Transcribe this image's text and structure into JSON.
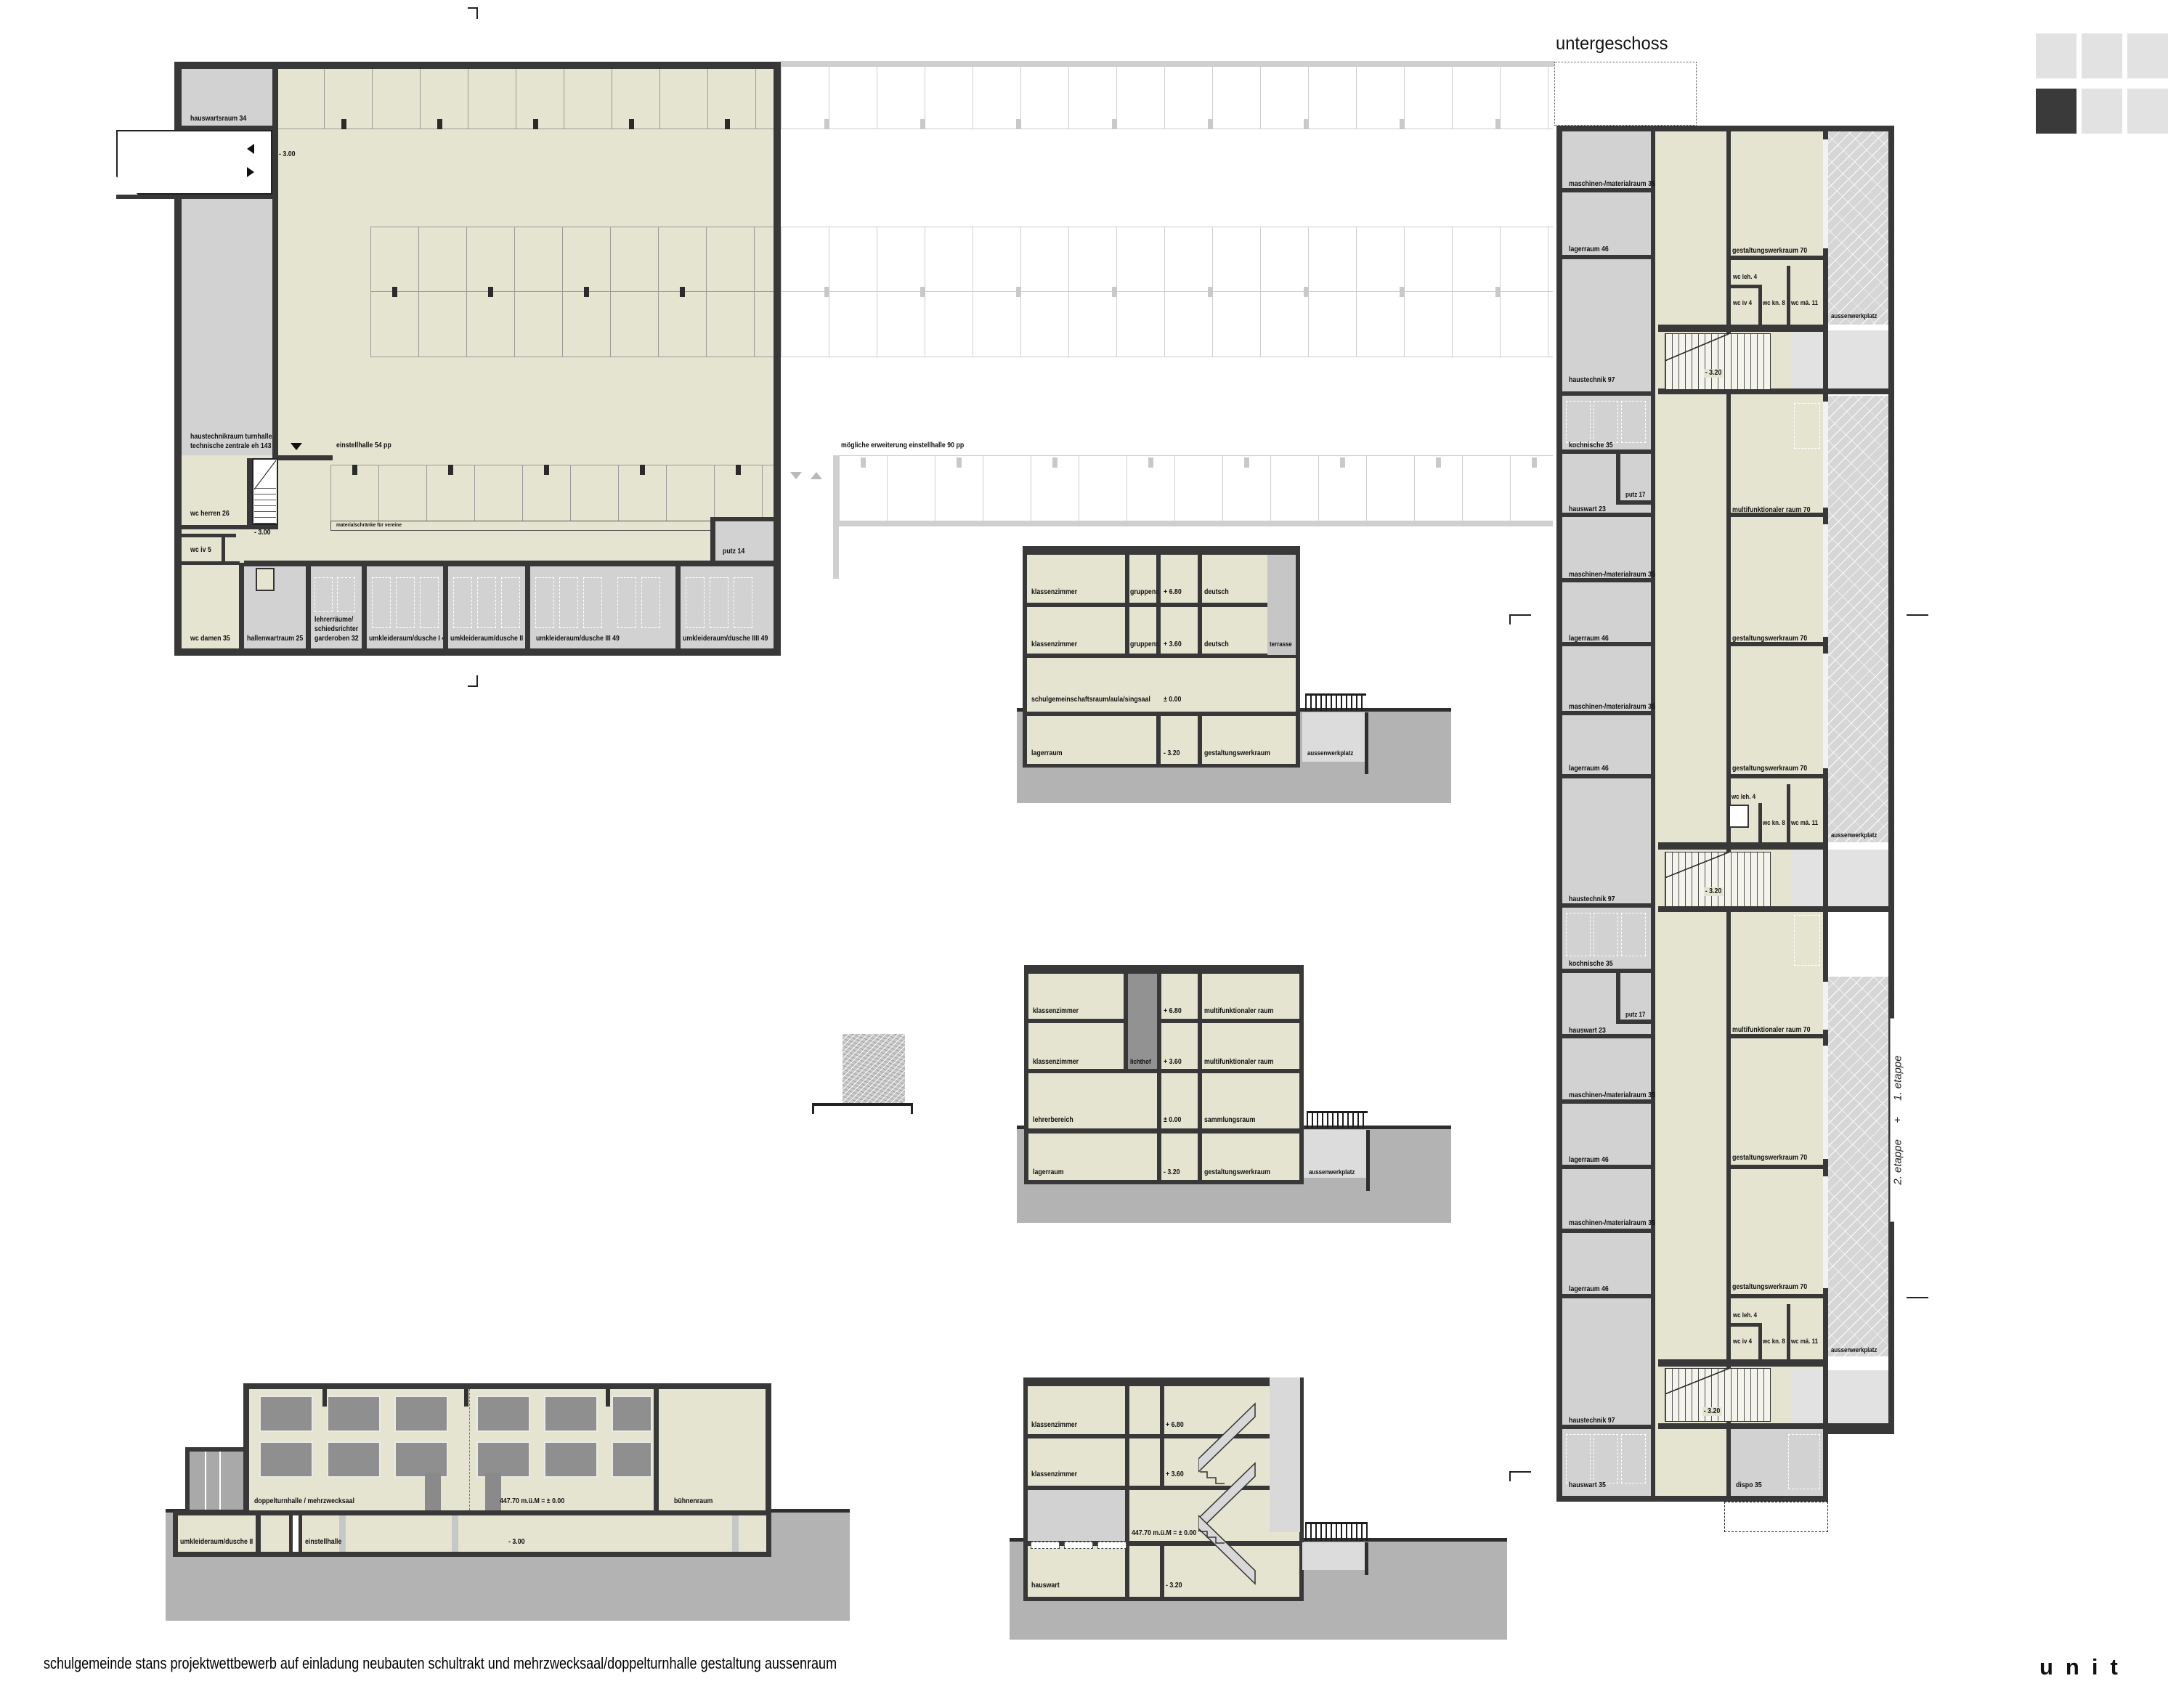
{
  "page": {
    "title": "untergeschoss",
    "footer_project": "schulgemeinde stans   projektwettbewerb auf einladung   neubauten schultrakt und mehrzwecksaal/doppelturnhalle gestaltung aussenraum",
    "logo": "unit"
  },
  "garage": {
    "hauswartsraum": "hauswartsraum 34",
    "level": "- 3.00",
    "haustechnik_1": "haustechnikraum turnhalle/",
    "haustechnik_2": "technische zentrale eh 143",
    "einstellhalle": "einstellhalle 54 pp",
    "materialschraenke": "materialschränke für vereine",
    "wc_herren": "wc herren 26",
    "wc_iv": "wc iv 5",
    "wc_damen": "wc damen 35",
    "hallenwart": "hallenwartraum 25",
    "lehrer_1": "lehrerräume/",
    "lehrer_2": "schiedsrichter",
    "lehrer_3": "garderoben 32",
    "umkleide1": "umkleideraum/dusche I 49",
    "umkleide2": "umkleideraum/dusche II 49",
    "umkleide3": "umkleideraum/dusche III 49",
    "umkleide4": "umkleideraum/dusche IIII 49",
    "putz": "putz 14",
    "erweiterung": "mögliche erweiterung einstellhalle 90 pp"
  },
  "strip": {
    "maschinen": "maschinen-/materialraum 35",
    "lagerraum": "lagerraum 46",
    "haustechnik": "haustechnik 97",
    "kochnische": "kochnische 35",
    "hauswart23": "hauswart 23",
    "putz17": "putz 17",
    "hauswart35": "hauswart 35",
    "dispo": "dispo 35",
    "gestaltung": "gestaltungswerkraum 70",
    "multifunktional": "multifunktionaler raum 70",
    "wc_leh": "wc leh. 4",
    "wc_iv": "wc iv 4",
    "wc_kn": "wc kn. 8",
    "wc_mae": "wc mä. 11",
    "aussenwerkplatz": "aussenwerkplatz",
    "level": "- 3.20",
    "etappe2": "2. etappe",
    "plus": "+",
    "etappe1": "1. etappe"
  },
  "sec": {
    "klassenzimmer": "klassenzimmer",
    "gruppenr": "gruppenr.",
    "deutsch": "deutsch",
    "terrasse": "terrasse",
    "aula": "schulgemeinschaftsraum/aula/singsaal",
    "lagerraum": "lagerraum",
    "gestaltungswerkraum": "gestaltungswerkraum",
    "aussenwerkplatz": "aussenwerkplatz",
    "lichthof": "lichthof",
    "multifunktional": "multifunktionaler raum",
    "lehrerbereich": "lehrerbereich",
    "sammlungsraum": "sammlungsraum",
    "hauswart": "hauswart",
    "lvl_680": "+ 6.80",
    "lvl_360": "+ 3.60",
    "lvl_0": "± 0.00",
    "lvl_m320": "- 3.20",
    "lvl_abs": "447.70 m.ü.M = ± 0.00"
  },
  "hall": {
    "doppelturnhalle": "doppelturnhalle / mehrzwecksaal",
    "lvl_abs": "447.70 m.ü.M = ± 0.00",
    "buehnenraum": "bühnenraum",
    "umkleide": "umkleideraum/dusche II",
    "einstellhalle": "einstellhalle",
    "level": "- 3.00"
  }
}
